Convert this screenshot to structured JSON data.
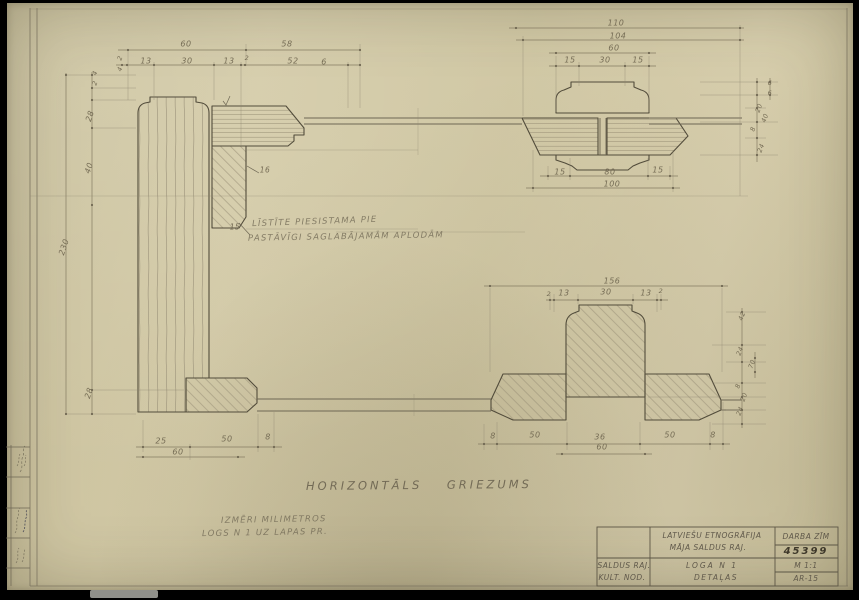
{
  "sheet": {
    "paper_color": "#cfc6a2",
    "pencil_color": "#524c3b",
    "type": "architectural pencil drawing, horizontal section of window frame details"
  },
  "annotations": {
    "note_line1": "LĪSTĪTE PIESISTAMA PIE",
    "note_line2": "PASTĀVĪGI SAGLABĀJAMĀM APLODĀM",
    "main_title": "HORIZONTĀLS GRIEZUMS",
    "sub_line1": "IZMĒRI MILIMETROS",
    "sub_line2": "LOGS N 1 UZ LAPAS PR."
  },
  "title_block": {
    "project_line1": "LATVIEŠU ETNOGRĀFIJA",
    "project_line2": "MĀJA SALDUS RAJ.",
    "office_line1": "SALDUS RAJ.",
    "office_line2": "KULT. NOD.",
    "drawing_line1": "LOGA N 1",
    "drawing_line2": "DETAĻAS",
    "doc_type": "DARBA ZĪM",
    "doc_number": "45399",
    "scale": "M 1:1",
    "sheet_number": "AR-15"
  },
  "dimension_labels": [
    {
      "t": "60",
      "x": 186,
      "y": 44
    },
    {
      "t": "58",
      "x": 287,
      "y": 44
    },
    {
      "t": "2",
      "x": 120,
      "y": 58,
      "r": -70,
      "s": 6.5
    },
    {
      "t": "4",
      "x": 120,
      "y": 69,
      "r": -70,
      "s": 6.5
    },
    {
      "t": "13",
      "x": 146,
      "y": 61
    },
    {
      "t": "30",
      "x": 187,
      "y": 61
    },
    {
      "t": "13",
      "x": 229,
      "y": 61
    },
    {
      "t": "2",
      "x": 247,
      "y": 58,
      "s": 6.5
    },
    {
      "t": "52",
      "x": 293,
      "y": 61
    },
    {
      "t": "6",
      "x": 324,
      "y": 62
    },
    {
      "t": "4",
      "x": 95,
      "y": 73,
      "r": -70,
      "s": 6.5
    },
    {
      "t": "2",
      "x": 95,
      "y": 83,
      "r": -70,
      "s": 6.5
    },
    {
      "t": "28",
      "x": 90,
      "y": 116,
      "r": -72
    },
    {
      "t": "40",
      "x": 89,
      "y": 168,
      "r": -72
    },
    {
      "t": "230",
      "x": 64,
      "y": 247,
      "r": -72
    },
    {
      "t": "28",
      "x": 89,
      "y": 393,
      "r": -72
    },
    {
      "t": "110",
      "x": 616,
      "y": 23
    },
    {
      "t": "104",
      "x": 618,
      "y": 36
    },
    {
      "t": "60",
      "x": 614,
      "y": 48
    },
    {
      "t": "15",
      "x": 570,
      "y": 60
    },
    {
      "t": "30",
      "x": 605,
      "y": 60
    },
    {
      "t": "15",
      "x": 638,
      "y": 60
    },
    {
      "t": "15",
      "x": 560,
      "y": 172
    },
    {
      "t": "80",
      "x": 610,
      "y": 172
    },
    {
      "t": "15",
      "x": 658,
      "y": 170
    },
    {
      "t": "100",
      "x": 612,
      "y": 184
    },
    {
      "t": "6",
      "x": 770,
      "y": 83,
      "s": 6.5
    },
    {
      "t": "6",
      "x": 770,
      "y": 93,
      "s": 6.5
    },
    {
      "t": "20",
      "x": 759,
      "y": 108,
      "r": -70,
      "s": 6.5
    },
    {
      "t": "40",
      "x": 765,
      "y": 118,
      "r": -70,
      "s": 6.5
    },
    {
      "t": "8",
      "x": 753,
      "y": 129,
      "r": -70,
      "s": 6.5
    },
    {
      "t": "24",
      "x": 761,
      "y": 148,
      "r": -70,
      "s": 6.5
    },
    {
      "t": "156",
      "x": 612,
      "y": 281
    },
    {
      "t": "2",
      "x": 549,
      "y": 294,
      "s": 6.5
    },
    {
      "t": "13",
      "x": 564,
      "y": 293
    },
    {
      "t": "30",
      "x": 606,
      "y": 292
    },
    {
      "t": "13",
      "x": 646,
      "y": 293
    },
    {
      "t": "2",
      "x": 661,
      "y": 291,
      "s": 6.5
    },
    {
      "t": "42",
      "x": 742,
      "y": 316,
      "r": -70,
      "s": 6.5
    },
    {
      "t": "24",
      "x": 740,
      "y": 351,
      "r": -70,
      "s": 6.5
    },
    {
      "t": "70",
      "x": 752,
      "y": 364,
      "r": -70,
      "s": 6.5
    },
    {
      "t": "8",
      "x": 738,
      "y": 386,
      "r": -70,
      "s": 6.5
    },
    {
      "t": "20",
      "x": 744,
      "y": 397,
      "r": -70,
      "s": 6.5
    },
    {
      "t": "24",
      "x": 740,
      "y": 411,
      "r": -70,
      "s": 6.5
    },
    {
      "t": "25",
      "x": 161,
      "y": 441
    },
    {
      "t": "50",
      "x": 227,
      "y": 439
    },
    {
      "t": "8",
      "x": 268,
      "y": 437
    },
    {
      "t": "60",
      "x": 178,
      "y": 452
    },
    {
      "t": "8",
      "x": 493,
      "y": 436
    },
    {
      "t": "50",
      "x": 535,
      "y": 435
    },
    {
      "t": "36",
      "x": 600,
      "y": 437
    },
    {
      "t": "50",
      "x": 670,
      "y": 435
    },
    {
      "t": "8",
      "x": 713,
      "y": 435
    },
    {
      "t": "60",
      "x": 602,
      "y": 447
    },
    {
      "t": "16",
      "x": 265,
      "y": 170,
      "s": 7.5
    },
    {
      "t": "15",
      "x": 235,
      "y": 227,
      "s": 7.5
    }
  ]
}
